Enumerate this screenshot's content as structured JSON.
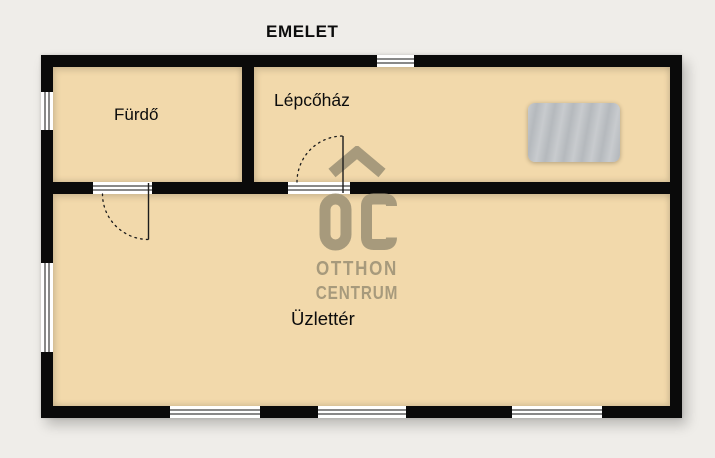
{
  "title": "EMELET",
  "rooms": [
    {
      "id": "furdo",
      "label": "Fürdő"
    },
    {
      "id": "lepcsohaz",
      "label": "Lépcőház"
    },
    {
      "id": "uzletter",
      "label": "Üzlettér"
    }
  ],
  "watermark": {
    "monogram": "OC",
    "line1": "OTTHON",
    "line2": "CENTRUM"
  },
  "icons": {
    "roof": "house-roof-chevron",
    "stairs": "striped-stair-mat"
  },
  "colors": {
    "background": "#efede9",
    "floor": "#f2d9ab",
    "wall": "#0a0a0a",
    "line": "#1c1c1c",
    "watermark": "#a79a7c",
    "label": "#0c0c0c",
    "stairs_base": "#b5b9bd",
    "stairs_stripe": "#c8cbce"
  }
}
